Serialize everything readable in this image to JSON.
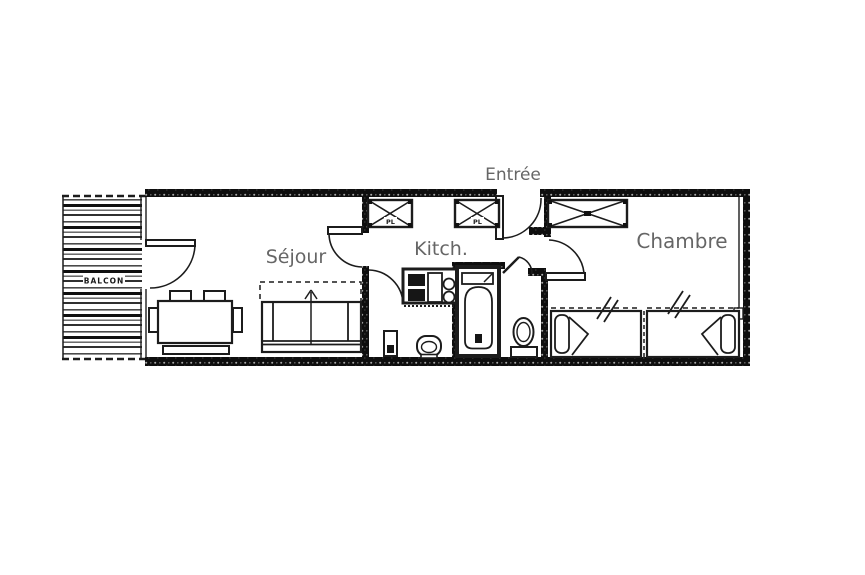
{
  "labels": {
    "entree": "Entrée",
    "sejour": "Séjour",
    "kitchen": "Kitch.",
    "chambre": "Chambre",
    "balcon": "BALCON",
    "closet1": "PL",
    "closet2": "PL"
  },
  "colors": {
    "background": "#ffffff",
    "wall": "#0e0e0e",
    "line": "#1c1c1c",
    "room_label": "#666666",
    "balcony_stripe": "#1a1a1a"
  }
}
